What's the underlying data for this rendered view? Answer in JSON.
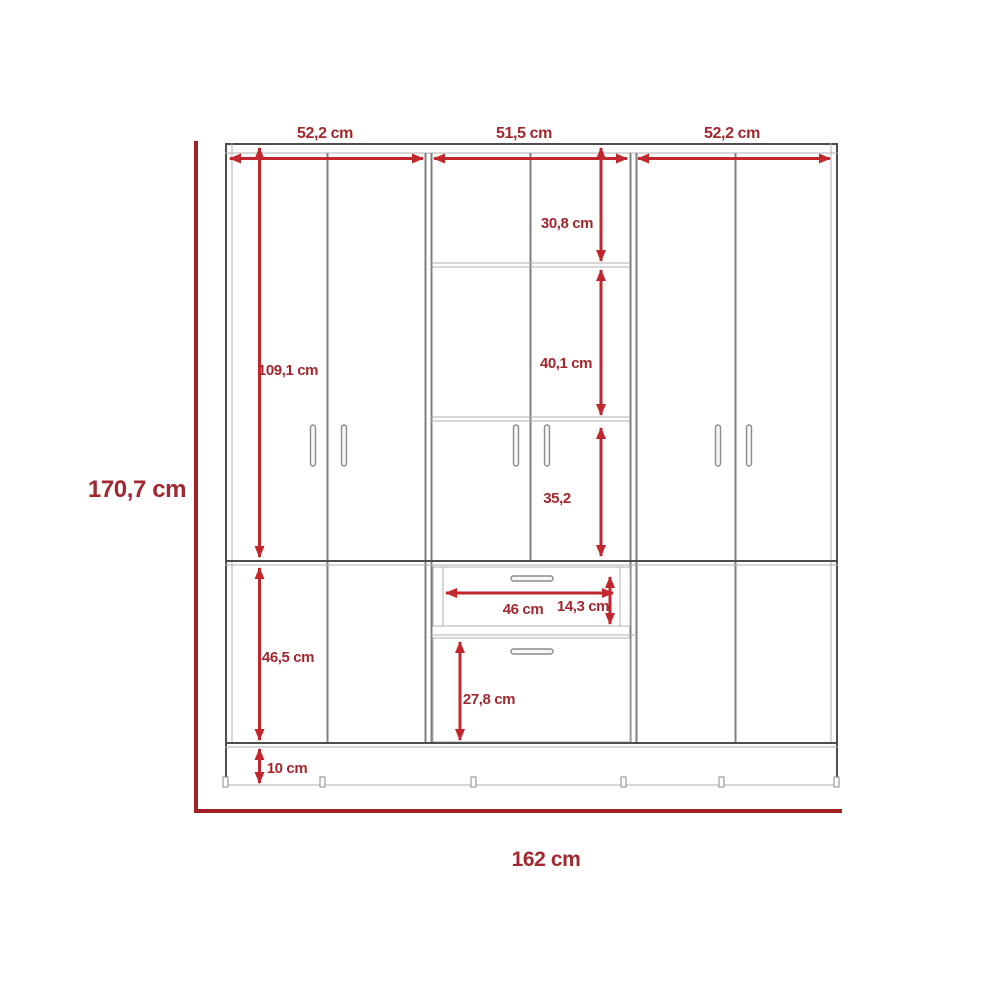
{
  "diagram": {
    "type": "furniture-technical-drawing",
    "subject": "wardrobe-front-elevation",
    "unit": "cm",
    "colors": {
      "dimension_red": "#c1272d",
      "label_red": "#a1282e",
      "frame_red": "#a32126",
      "outline_grey": "#4d4d4d"
    },
    "labels": {
      "total_height": "170,7 cm",
      "total_width": "162 cm",
      "section_left_width": "52,2 cm",
      "section_middle_width": "51,5 cm",
      "section_right_width": "52,2 cm",
      "upper_door_height": "109,1 cm",
      "top_shelf_height": "30,8 cm",
      "middle_shelf_height": "40,1 cm",
      "lower_cabinet_height": "35,2",
      "drawer_width": "46 cm",
      "drawer_height": "14,3 cm",
      "bottom_door_height": "27,8 cm",
      "lower_section_height": "46,5 cm",
      "base_height": "10 cm"
    }
  }
}
